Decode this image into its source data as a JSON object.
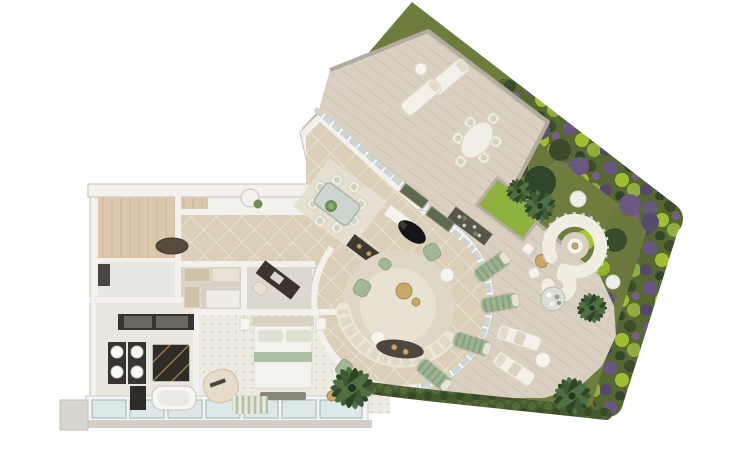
{
  "scene": {
    "name": "penthouse-apartment-3d-floor-plan",
    "description": "Top-down 3D architectural render of an apartment with curved glass living room, wrap-around wood deck, lawn, flower garden border and spa lounge. No text labels are rendered in the image.",
    "background": "#ffffff"
  },
  "palette": {
    "background": "#ffffff",
    "lawn": "#6e7c3e",
    "lawnDark": "#647236",
    "gardenBase": "#566832",
    "purple": "#6b5880",
    "purpleDark": "#4e4161",
    "brightGreen": "#a6c82e",
    "shrubDark": "#3a4c2a",
    "deck": "#d9d0c1",
    "deckLine": "#c4b9a8",
    "deckWall": "#b3ab9d",
    "wallWhite": "#f3f1ed",
    "wallEdge": "#d0cabf",
    "tile": "#dccfb8",
    "carpet": "#d8d2c6",
    "wood": "#dcc9ab",
    "bathFloor": "#e9e6e0",
    "windowPane": "#dde8eb",
    "glass": "#ccd4d6",
    "marble": "#39342f",
    "gold": "#c9a869",
    "cream": "#f2efe8",
    "sofa": "#ece6d7",
    "cushion": "#a3b795",
    "rug": "#ded7c5",
    "rugInner": "#e8e2d3",
    "black": "#161616",
    "hedge": "#46592f",
    "palm": "#3f5a35",
    "flowerBall": "#dcdcd6",
    "sphere": "#ededea"
  },
  "rooms": [
    {
      "id": "foyer",
      "floor": "wood",
      "items": [
        "pet-bed"
      ]
    },
    {
      "id": "laundry-room",
      "floor": "stone",
      "items": [
        "appliance"
      ]
    },
    {
      "id": "hallway",
      "floor": "diagonal-tile",
      "items": [
        "wall-niche",
        "plant"
      ]
    },
    {
      "id": "walk-in-closet",
      "floor": "carpet",
      "items": [
        "wardrobe",
        "wardrobe",
        "island-dresser"
      ]
    },
    {
      "id": "study-nook",
      "floor": "carpet",
      "items": [
        "desk",
        "desk-chair"
      ]
    },
    {
      "id": "bathroom",
      "floor": "stone",
      "items": [
        "double-vanity",
        "four-sinks",
        "marble-shower",
        "bathtub",
        "marble-wall-mirrors"
      ]
    },
    {
      "id": "bedroom",
      "floor": "patterned-tile",
      "items": [
        "double-bed",
        "two-nightstands",
        "foot-bench",
        "curved-chaise",
        "striped-rug",
        "two-green-armchairs",
        "side-table"
      ]
    },
    {
      "id": "dining-area",
      "floor": "diagonal-tile",
      "items": [
        "glass-dining-table",
        "eight-chairs",
        "plant-centerpiece",
        "rug",
        "white-sideboard",
        "marble-console",
        "grand-piano"
      ]
    },
    {
      "id": "living-room",
      "floor": "diagonal-tile",
      "items": [
        "curved-sofa",
        "round-rug",
        "green-armchairs",
        "gold-coffee-table",
        "round-side-tables",
        "dark-console-rug"
      ]
    }
  ],
  "outdoor": [
    {
      "id": "upper-deck",
      "items": [
        "two-sun-loungers",
        "round-side-table",
        "oval-dining-table",
        "six-chairs"
      ]
    },
    {
      "id": "main-deck",
      "items": [
        "raised-grass-planter",
        "gabion-stone-planter",
        "hedge-planters",
        "four-green-striped-loungers",
        "two-white-loungers",
        "lounger-side-table",
        "bistro-chairs",
        "gold-bistro-table"
      ]
    },
    {
      "id": "spa-lounge",
      "items": [
        "spiral-bench",
        "round-table",
        "flower-ball-planter",
        "two-sphere-lamps"
      ]
    },
    {
      "id": "garden",
      "items": [
        "lawn",
        "lavender-border",
        "bright-shrubs",
        "dark-shrubs",
        "five-palm-trees",
        "hedge-row"
      ]
    }
  ]
}
